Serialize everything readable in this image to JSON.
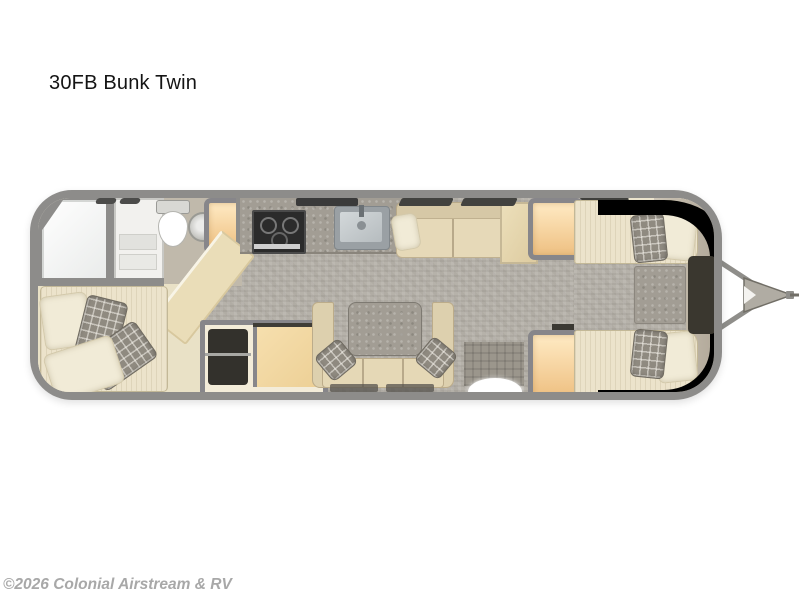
{
  "title": "30FB Bunk Twin",
  "watermark": "©2026 Colonial Airstream & RV",
  "floorplan": {
    "type": "travel-trailer top-view floorplan",
    "orientation": "rear on left, hitch on right",
    "colors": {
      "wall": "#8d8c8a",
      "floor_cream": "#e8e0ca",
      "carpet_gray": "#b6b2aa",
      "furniture_cream": "#ece3cb",
      "cabinet_orange": "#f0c488",
      "granite_gray": "#a29d94",
      "appliance_dark": "#2b2b2b",
      "front_trim_dark": "#48443a",
      "shower_white": "#f7f7f5"
    },
    "rooms": [
      {
        "name": "rear-bedroom",
        "features": [
          "corner bed with cream and plaid pillows",
          "wardrobe with hanging clothes",
          "cabinet"
        ]
      },
      {
        "name": "bathroom",
        "features": [
          "corner shower",
          "white vanity shelves",
          "toilet",
          "round sink",
          "tall cabinet",
          "angled counter"
        ]
      },
      {
        "name": "kitchen",
        "features": [
          "dark cooktop",
          "stainless square sink",
          "granite countertop",
          "range hood vent"
        ]
      },
      {
        "name": "living-area",
        "features": [
          "sofa with throw pillow",
          "side cabinet",
          "dinette with granite table",
          "two plaid pillows",
          "floor mats",
          "entry step"
        ]
      },
      {
        "name": "front-bedroom",
        "features": [
          "twin bed top",
          "twin bed bottom",
          "granite nightstand",
          "dark front console",
          "two orange wardrobes",
          "curved dark front trim"
        ]
      }
    ],
    "hitch": "A-frame tongue with coupler bar on right"
  }
}
